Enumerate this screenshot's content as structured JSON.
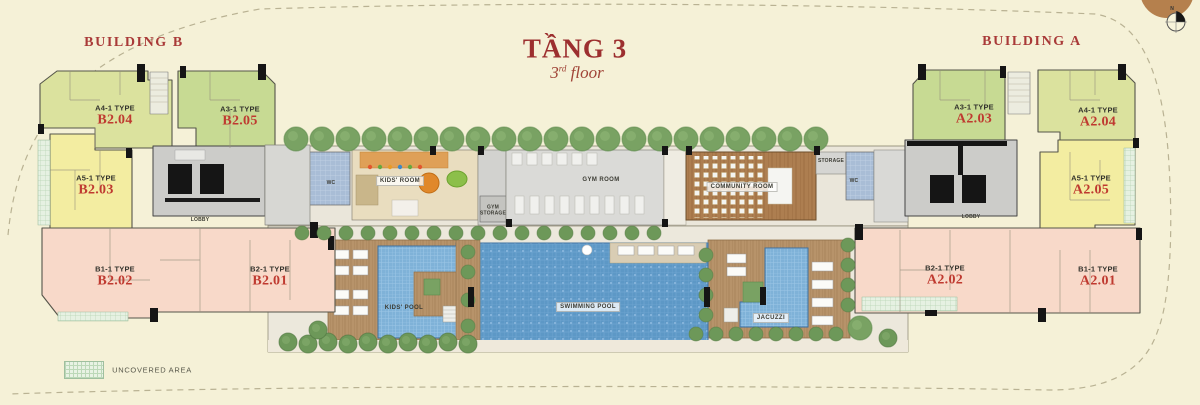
{
  "title": {
    "main": "TẦNG 3",
    "sub_num": "3",
    "sub_ord": "rd",
    "sub_word": " floor"
  },
  "buildings": {
    "left": "BUILDING B",
    "right": "BUILDING A"
  },
  "compass": {
    "north": "N"
  },
  "units": {
    "b204": {
      "type": "A4-1 TYPE",
      "code": "B2.04"
    },
    "b205": {
      "type": "A3-1 TYPE",
      "code": "B2.05"
    },
    "b203": {
      "type": "A5-1 TYPE",
      "code": "B2.03"
    },
    "b202": {
      "type": "B1-1 TYPE",
      "code": "B2.02"
    },
    "b201": {
      "type": "B2-1 TYPE",
      "code": "B2.01"
    },
    "a203": {
      "type": "A3-1 TYPE",
      "code": "A2.03"
    },
    "a204": {
      "type": "A4-1 TYPE",
      "code": "A2.04"
    },
    "a205": {
      "type": "A5-1 TYPE",
      "code": "A2.05"
    },
    "a202": {
      "type": "B2-1 TYPE",
      "code": "A2.02"
    },
    "a201": {
      "type": "B1-1 TYPE",
      "code": "A2.01"
    }
  },
  "rooms": {
    "wc_left": "WC",
    "kids_room": "KIDS' ROOM",
    "gym_storage": "GYM STORAGE",
    "gym_room": "GYM ROOM",
    "community_room": "COMMUNITY ROOM",
    "storage": "STORAGE",
    "wc_right": "WC",
    "lobby_left": "LOBBY",
    "lobby_right": "LOBBY"
  },
  "pools": {
    "kids_pool": "KIDS' POOL",
    "swimming_pool": "SWIMMING POOL",
    "jacuzzi": "JACUZZI"
  },
  "legend": {
    "uncovered_area": "UNCOVERED AREA"
  },
  "colors": {
    "background": "#f5f1d7",
    "accent_red": "#a93a38",
    "unit_green": "#c7da93",
    "unit_yellow_green": "#dbe29e",
    "unit_yellow": "#f3eda1",
    "unit_pink": "#f8d9c9",
    "pool_blue": "#5d98c6",
    "wood": "#b7936a"
  }
}
